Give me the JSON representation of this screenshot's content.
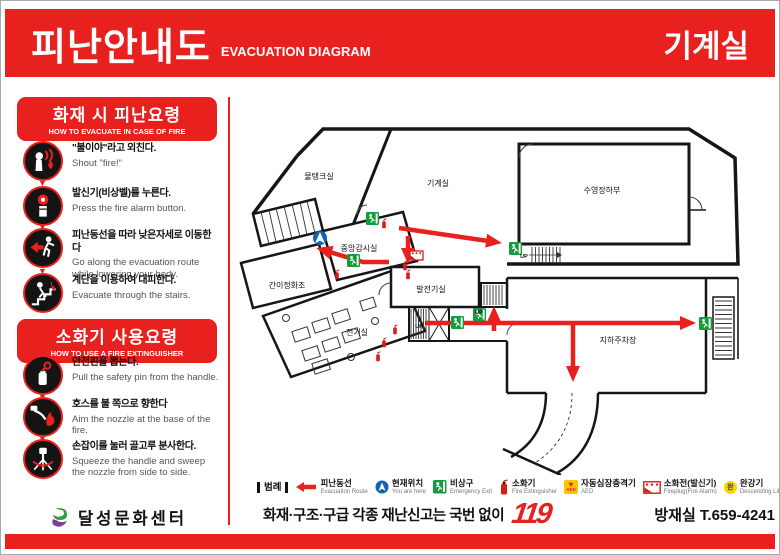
{
  "header": {
    "title_ko": "피난안내도",
    "title_en": "EVACUATION DIAGRAM",
    "location": "기계실"
  },
  "sidebar": {
    "fire": {
      "title_ko": "화재 시 피난요령",
      "title_en": "HOW TO EVACUATE IN CASE OF FIRE",
      "steps": [
        {
          "icon": "shout-icon",
          "ko": "\"불이야\"라고 외친다.",
          "en": "Shout \"fire!\""
        },
        {
          "icon": "alarm-button-icon",
          "ko": "발신기(비상벨)를 누른다.",
          "en": "Press the fire alarm button."
        },
        {
          "icon": "evacuation-route-icon",
          "ko": "피난동선을 따라 낮은자세로 이동한다",
          "en": "Go along the evacuation route while lowering your body."
        },
        {
          "icon": "stairs-escape-icon",
          "ko": "계단을 이용하여 대피한다.",
          "en": "Evacuate through the stairs."
        }
      ]
    },
    "extinguisher": {
      "title_ko": "소화기 사용요령",
      "title_en": "HOW TO USE A FIRE EXTINGUISHER",
      "steps": [
        {
          "icon": "safety-pin-icon",
          "ko": "안전핀을 뽑는다.",
          "en": "Pull the safety pin from the handle."
        },
        {
          "icon": "aim-nozzle-icon",
          "ko": "호스를 불 쪽으로 향한다",
          "en": "Aim the nozzle at the base of the fire."
        },
        {
          "icon": "squeeze-handle-icon",
          "ko": "손잡이를 눌러 골고루 분사한다.",
          "en": "Squeeze the handle and sweep the nozzle from side to side."
        }
      ]
    },
    "org_name": "달성문화센터"
  },
  "floorplan": {
    "rooms": [
      "물탱크실",
      "기계실",
      "수영장하부",
      "중앙감시실",
      "간이정화조",
      "발전기실",
      "전기실",
      "지하주차장"
    ],
    "stairs_label": "UP"
  },
  "legend": {
    "title": "범례",
    "items": [
      {
        "icon": "evacuation-route-icon",
        "ko": "피난동선",
        "en": "Evacuation Route"
      },
      {
        "icon": "current-location-icon",
        "ko": "현재위치",
        "en": "You are here"
      },
      {
        "icon": "emergency-exit-icon",
        "ko": "비상구",
        "en": "Emergency Exit"
      },
      {
        "icon": "fire-extinguisher-icon",
        "ko": "소화기",
        "en": "Fire Extinguisher"
      },
      {
        "icon": "aed-icon",
        "icon_text": "AED",
        "ko": "자동심장충격기",
        "en": "AED"
      },
      {
        "icon": "fireplug-icon",
        "ko": "소화전(발신기)",
        "en": "Fireplug(Fire Alarm)"
      },
      {
        "icon": "descending-life-line-icon",
        "icon_char": "완",
        "ko": "완강기",
        "en": "Descending Life Line"
      }
    ]
  },
  "footer": {
    "emergency_text": "화재·구조·구급 각종 재난신고는 국번 없이",
    "emergency_number": "119",
    "control_room": "방재실 T.659-4241"
  },
  "colors": {
    "accent_red": "#e8201e",
    "exit_green": "#169b3e",
    "location_blue": "#1263b2",
    "aed_yellow": "#f7c600"
  }
}
